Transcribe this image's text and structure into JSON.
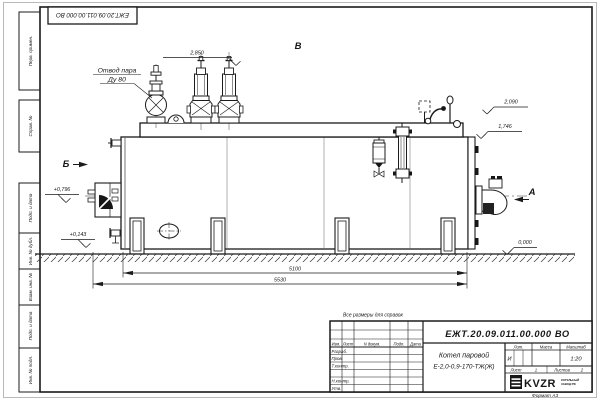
{
  "sheet": {
    "top_stamp": "ЕЖТ.20.09.011.00.000 ВО",
    "format_note": "Формат А3",
    "reference_note": "Все размеры для справок"
  },
  "margin": {
    "perv": "Перв. примен.",
    "sprav": "Справ. №",
    "podp1": "Подп. и дата",
    "inv_dubl": "Инв. № дубл.",
    "vzam": "Взам. инв. №",
    "podp2": "Подп. и дата",
    "inv_podl": "Инв. № подл."
  },
  "views": {
    "top": "В",
    "left": "Б",
    "right": "А"
  },
  "labels": {
    "steam_line1": "Отвод пара",
    "steam_line2": "Ду 80"
  },
  "elevations": {
    "top_left": "2,850",
    "right_upper": "2,090",
    "right_lower": "1,746",
    "left_upper": "+0,796",
    "left_lower": "+0,143",
    "ground": "0,000"
  },
  "dimensions": {
    "between_edges": "5100",
    "overall": "5530"
  },
  "title_block": {
    "doc_number": "ЕЖТ.20.09.011.00.000 ВО",
    "name_line1": "Котел паровой",
    "name_line2": "Е-2,0-0,9-170-ТЖ(Ж)",
    "headers": {
      "izm": "Изм.",
      "list": "Лист",
      "ndoc": "N докум.",
      "podp": "Подп.",
      "data": "Дата"
    },
    "rows": {
      "r1": "Разраб.",
      "r2": "Пров.",
      "r3": "Т.контр.",
      "r4": "Н.контр.",
      "r5": "Утв."
    },
    "lit_header": "Лит.",
    "mass_header": "Масса",
    "scale_header": "Масштаб",
    "lit_value": "И",
    "scale_value": "1:20",
    "sheet_label": "Лист",
    "sheet_number": "1",
    "sheets_label": "Листов",
    "sheets_total": "2",
    "company_logo": "KVZR",
    "company_name_line1": "КОТЕЛЬНЫЙ",
    "company_name_line2": "ЗАВОД РФ"
  }
}
